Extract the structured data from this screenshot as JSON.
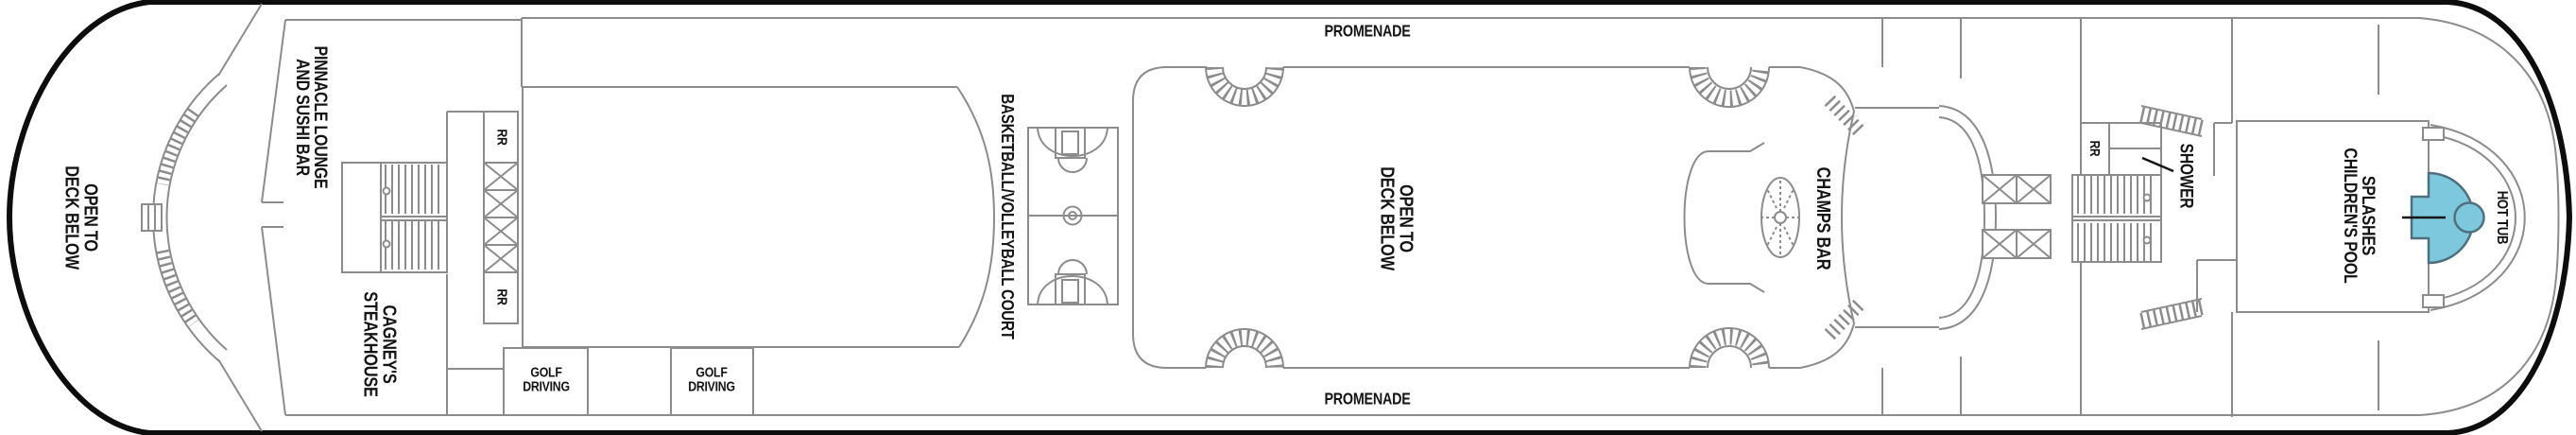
{
  "title": "Cruise ship deck plan",
  "colors": {
    "hull_outline": "#0d0d0d",
    "interior_walls": "#8c8c8c",
    "label_text": "#141414",
    "pool_fill": "#7dc8dc",
    "pool_stroke": "#4e707e"
  },
  "labels": {
    "open_below_bow": {
      "line1": "OPEN TO",
      "line2": "DECK BELOW"
    },
    "pinnacle_lounge": {
      "line1": "PINNACLE LOUNGE",
      "line2": "AND SUSHI BAR"
    },
    "cagneys": {
      "line1": "CAGNEY'S",
      "line2": "STEAKHOUSE"
    },
    "rr_forward_top": {
      "text": "RR"
    },
    "rr_forward_bottom": {
      "text": "RR"
    },
    "golf_driving_1": {
      "line1": "GOLF",
      "line2": "DRIVING"
    },
    "golf_driving_2": {
      "line1": "GOLF",
      "line2": "DRIVING"
    },
    "basketball_court": {
      "text": "BASKETBALL/VOLLEYBALL COURT"
    },
    "promenade_top": {
      "text": "PROMENADE"
    },
    "promenade_bottom": {
      "text": "PROMENADE"
    },
    "open_below_center": {
      "line1": "OPEN TO",
      "line2": "DECK BELOW"
    },
    "champs_bar": {
      "text": "CHAMPS BAR"
    },
    "rr_midship": {
      "text": "RR"
    },
    "shower": {
      "text": "SHOWER"
    },
    "splashes_pool": {
      "line1": "SPLASHES",
      "line2": "CHILDREN'S POOL"
    },
    "hot_tub": {
      "text": "HOT TUB"
    }
  }
}
